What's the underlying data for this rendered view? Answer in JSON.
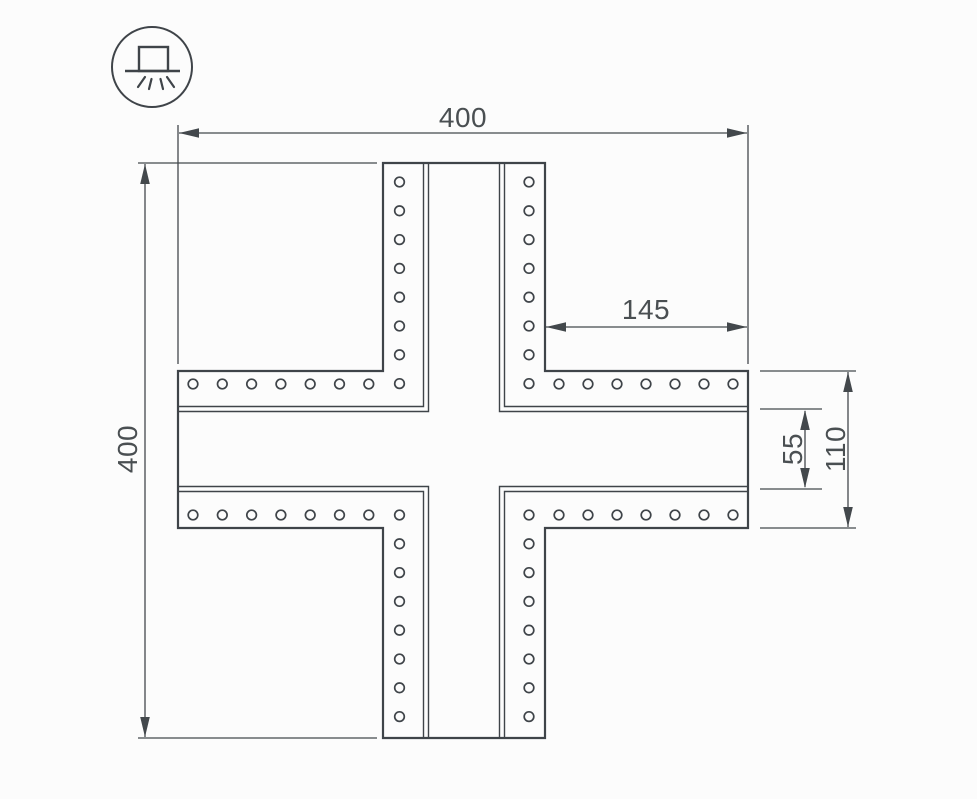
{
  "meta": {
    "background": "#fcfcfc",
    "line_color": "#3f4449",
    "text_color": "#4a4f52"
  },
  "icon": {
    "type": "surface-mounted-luminaire"
  },
  "dimensions": {
    "overall_width": "400",
    "overall_height": "400",
    "arm_length": "145",
    "channel_width": "55",
    "arm_width": "110"
  },
  "holes": {
    "per_column": 8,
    "per_row": 8,
    "total": 60
  }
}
